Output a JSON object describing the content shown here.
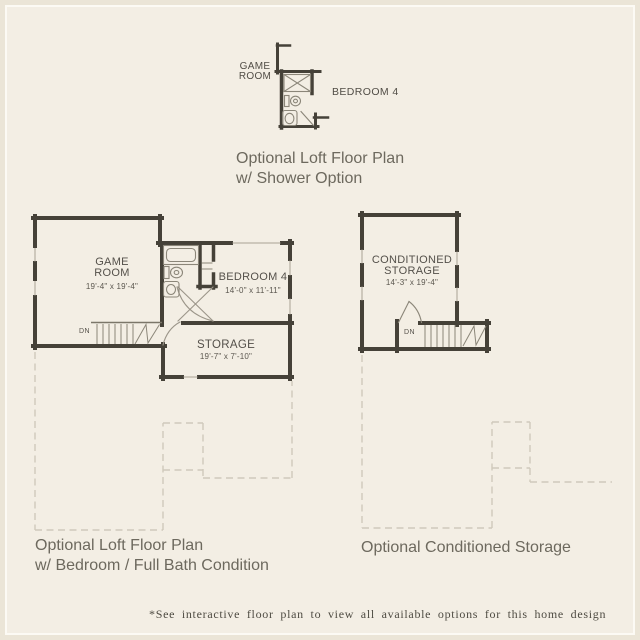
{
  "colors": {
    "background": "#f3eee4",
    "edge_border": "#ebe5d7",
    "frame_line": "#fcfaf4",
    "wall": "#454138",
    "fixture_line": "#8b8679",
    "dashed_outline": "#cfc9bb",
    "room_label": "#54504a",
    "caption": "#6d695e",
    "footnote": "#4e4b42"
  },
  "shower_plan": {
    "game_room_label_line1": "GAME",
    "game_room_label_line2": "ROOM",
    "bedroom_label": "BEDROOM 4",
    "caption_line1": "Optional Loft Floor Plan",
    "caption_line2": "w/ Shower Option"
  },
  "loft_plan": {
    "game_room": {
      "line1": "GAME",
      "line2": "ROOM",
      "dims": "19'-4\" x 19'-4\""
    },
    "bedroom": {
      "name": "BEDROOM 4",
      "dims": "14'-0\" x 11'-11\""
    },
    "storage": {
      "name": "STORAGE",
      "dims": "19'-7\" x 7'-10\""
    },
    "stair_label": "DN",
    "caption_line1": "Optional Loft Floor Plan",
    "caption_line2": "w/ Bedroom / Full Bath Condition"
  },
  "storage_plan": {
    "room_line1": "CONDITIONED",
    "room_line2": "STORAGE",
    "dims": "14'-3\" x 19'-4\"",
    "stair_label": "DN",
    "caption": "Optional Conditioned Storage"
  },
  "footnote": "*See interactive floor plan to view all available options for this home design"
}
